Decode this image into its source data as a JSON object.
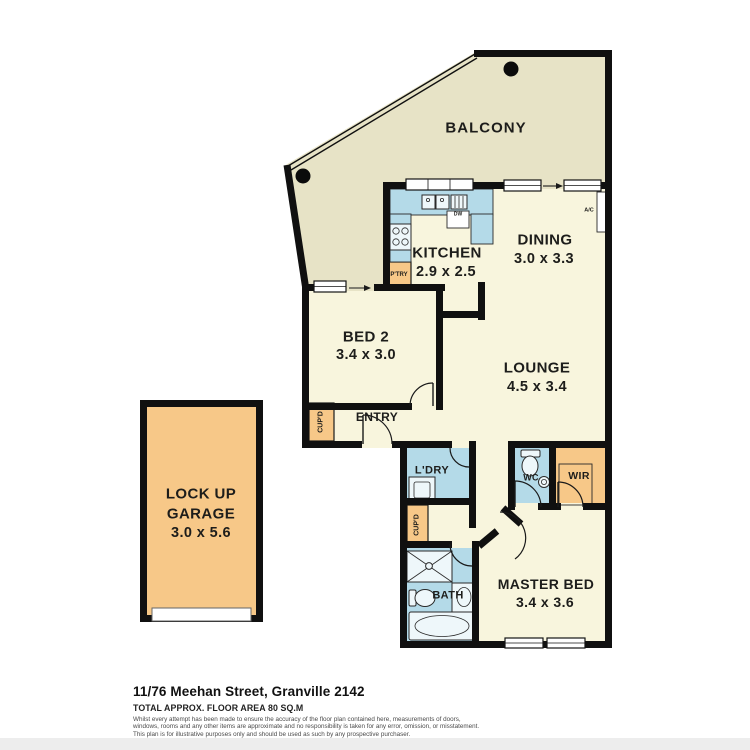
{
  "plan": {
    "colors": {
      "unit": "#F8F5DD",
      "balcony": "#E7E3C6",
      "wet": "#B4DAE8",
      "storage": "#F7C888",
      "wall": "#101010"
    },
    "rooms": {
      "balcony": {
        "label": "BALCONY"
      },
      "kitchen": {
        "label": "KITCHEN",
        "dims": "2.9 x 2.5"
      },
      "dining": {
        "label": "DINING",
        "dims": "3.0 x 3.3"
      },
      "bed2": {
        "label": "BED 2",
        "dims": "3.4 x 3.0"
      },
      "lounge": {
        "label": "LOUNGE",
        "dims": "4.5 x 3.4"
      },
      "master": {
        "label": "MASTER BED",
        "dims": "3.4 x 3.6"
      },
      "entry": {
        "label": "ENTRY"
      },
      "laundry": {
        "label": "L'DRY"
      },
      "wc": {
        "label": "WC"
      },
      "wir": {
        "label": "WIR"
      },
      "bath": {
        "label": "BATH"
      },
      "cupd_entry": {
        "label": "CUP'D"
      },
      "cupd_hall": {
        "label": "CUP'D"
      },
      "pantry": {
        "label": "P'TRY"
      },
      "ac": {
        "label": "A/C"
      },
      "dw": {
        "label": "DW"
      },
      "garage": {
        "line1": "LOCK UP",
        "line2": "GARAGE",
        "dims": "3.0 x 5.6"
      }
    },
    "footer": {
      "address": "11/76 Meehan Street, Granville 2142",
      "area": "TOTAL APPROX. FLOOR AREA 80 SQ.M",
      "disclaimer1": "Whilst every attempt has been made to ensure the accuracy of the floor plan contained here, measurements of doors,",
      "disclaimer2": "windows, rooms and any other items are approximate and no responsibility is taken for any error, omission, or misstatement.",
      "disclaimer3": "This plan is for illustrative purposes only and should be used as such by any prospective purchaser."
    }
  }
}
